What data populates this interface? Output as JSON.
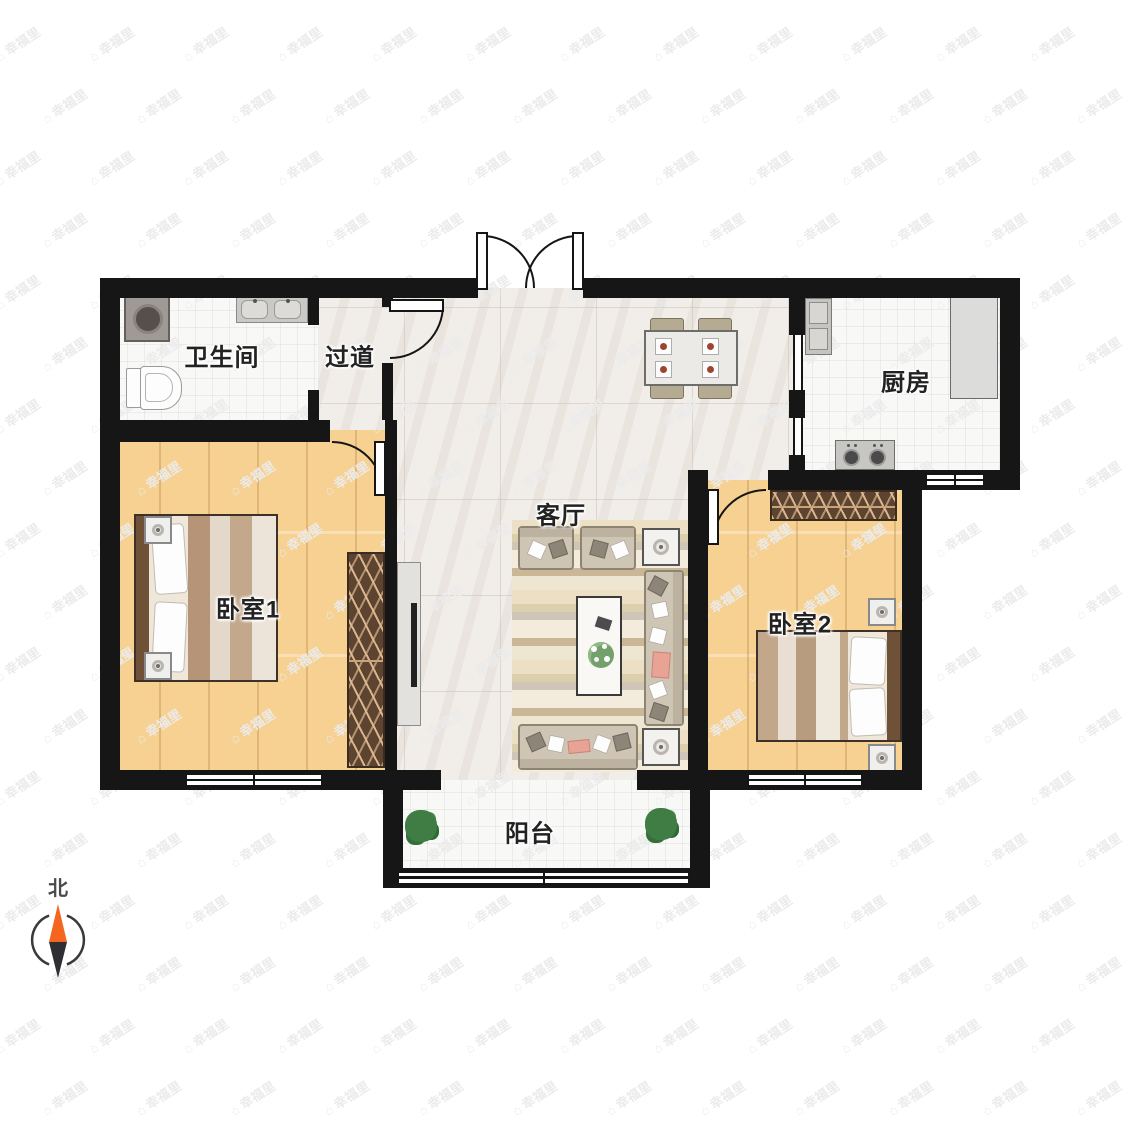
{
  "rooms": [
    {
      "id": "bathroom",
      "label": "卫生间"
    },
    {
      "id": "hallway",
      "label": "过道"
    },
    {
      "id": "kitchen",
      "label": "厨房"
    },
    {
      "id": "living",
      "label": "客厅"
    },
    {
      "id": "bedroom1",
      "label": "卧室1"
    },
    {
      "id": "bedroom2",
      "label": "卧室2"
    },
    {
      "id": "balcony",
      "label": "阳台"
    }
  ],
  "compass": {
    "label": "北"
  },
  "watermark": {
    "icon": "⌂",
    "text": "幸福里"
  },
  "colors": {
    "wall": "#161616",
    "wood_floor": "#f6d192",
    "marble_floor": "#f1ede8",
    "tile_floor": "#f8f8f7",
    "wardrobe": "#5d4431",
    "compass_north": "#f4661f",
    "compass_south": "#2f2f33",
    "sofa": "#cfc5b4",
    "accent_pink": "#e8a394",
    "plant_green": "#3f7d44"
  }
}
